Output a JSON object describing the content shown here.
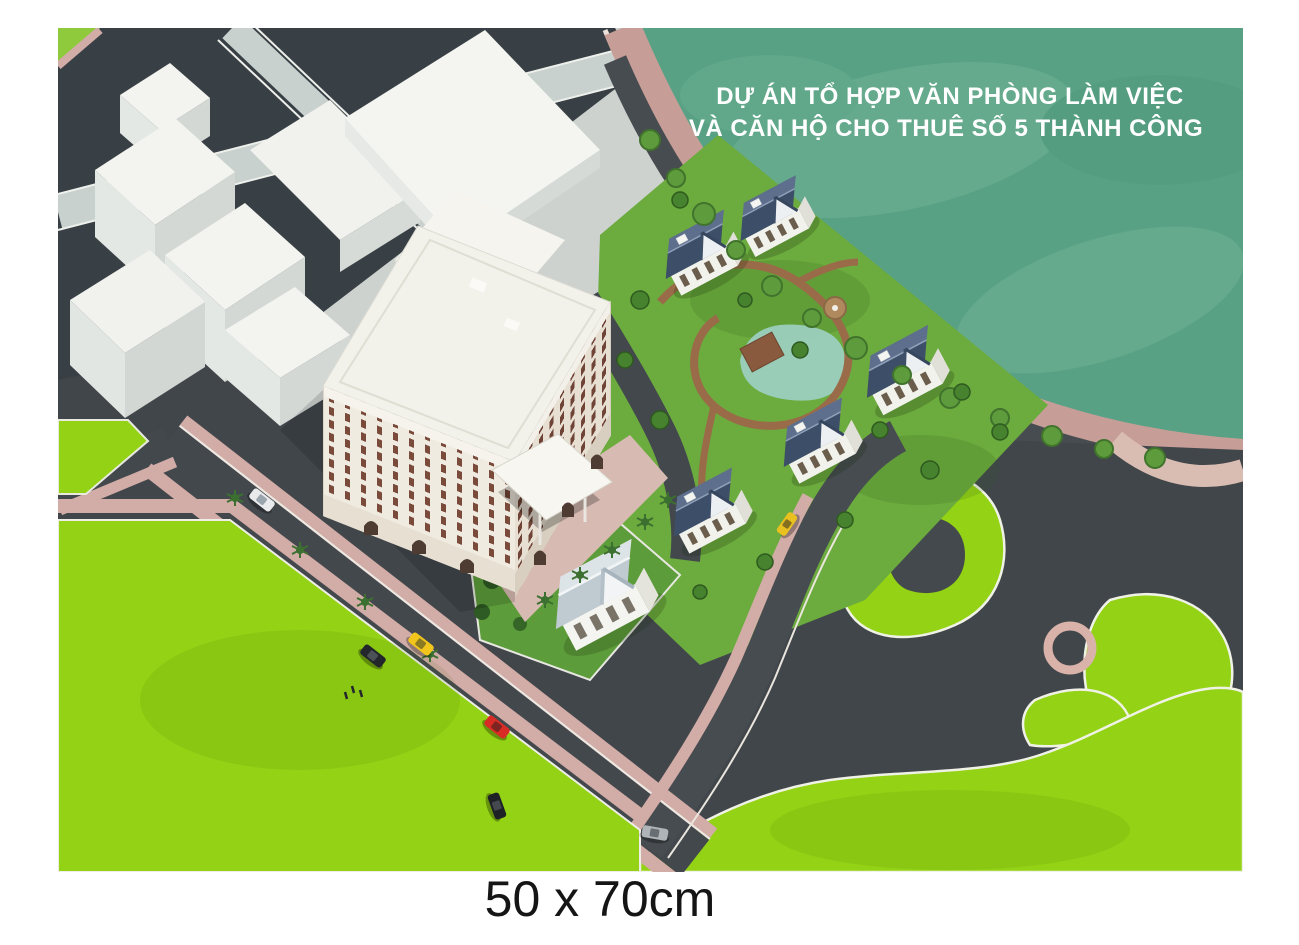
{
  "poster": {
    "title": {
      "line1": "DỰ ÁN TỔ HỢP VĂN PHÒNG LÀM VIỆC",
      "line2": "VÀ CĂN HỘ CHO THUÊ SỐ 5 THÀNH CÔNG"
    },
    "size_caption": "50 x 70cm"
  },
  "palette": {
    "title_white": "#ffffff",
    "caption_black": "#151515",
    "water": "#58a184",
    "promenade_pink": "#c79e97",
    "sidewalk_pink": "#d2aca6",
    "asphalt_dark": "#41464b",
    "road_light_gray": "#c9d1ce",
    "lawn_lime": "#93d214",
    "villa_grass": "#6cab3d",
    "building_white": "#f2f1ea",
    "window_brown": "#6f4335",
    "villa_roof_blue": "#3d4e68",
    "corner_villa_roof": "#c2cdd3",
    "taxi_yellow": "#f2c51d",
    "car_red": "#d92b26"
  }
}
